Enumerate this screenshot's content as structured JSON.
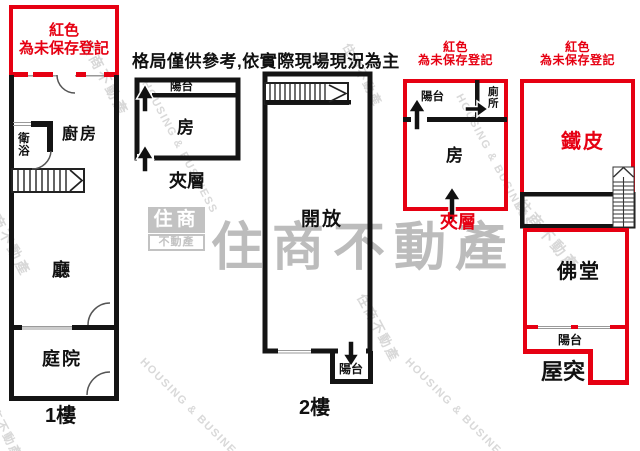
{
  "colors": {
    "unregistered_red": "#e60012",
    "wall_black": "#141414",
    "watermark_gray": "#c2c2c2",
    "watermark_big_gray": "#b5b5b5",
    "watermark_light_gray": "#d9d9d9"
  },
  "disclaimer": "格局僅供參考,依實際現場現況為主",
  "red_note": {
    "line1": "紅色",
    "line2": "為未保存登記"
  },
  "floor1": {
    "floor_label": "1樓",
    "kitchen": "廚房",
    "bathroom": "衛浴",
    "living_room": "廳",
    "courtyard": "庭院"
  },
  "mezzanine_left": {
    "label": "夾層",
    "balcony": "陽台",
    "room": "房"
  },
  "floor2": {
    "floor_label": "2樓",
    "open_space": "開放",
    "balcony": "陽台"
  },
  "mezzanine_right": {
    "label": "夾層",
    "balcony": "陽台",
    "toilet": "廁所",
    "room": "房"
  },
  "rooftop": {
    "label": "屋突",
    "metal_shed": "鐵皮",
    "buddhist_hall": "佛堂",
    "balcony": "陽台"
  },
  "watermarks": {
    "logo_top": "住商",
    "logo_bottom": "不動產",
    "brand_large": "住商不動產",
    "brand_small": "住商不動產",
    "housing_business": "HOUSING & BUSINESS"
  }
}
